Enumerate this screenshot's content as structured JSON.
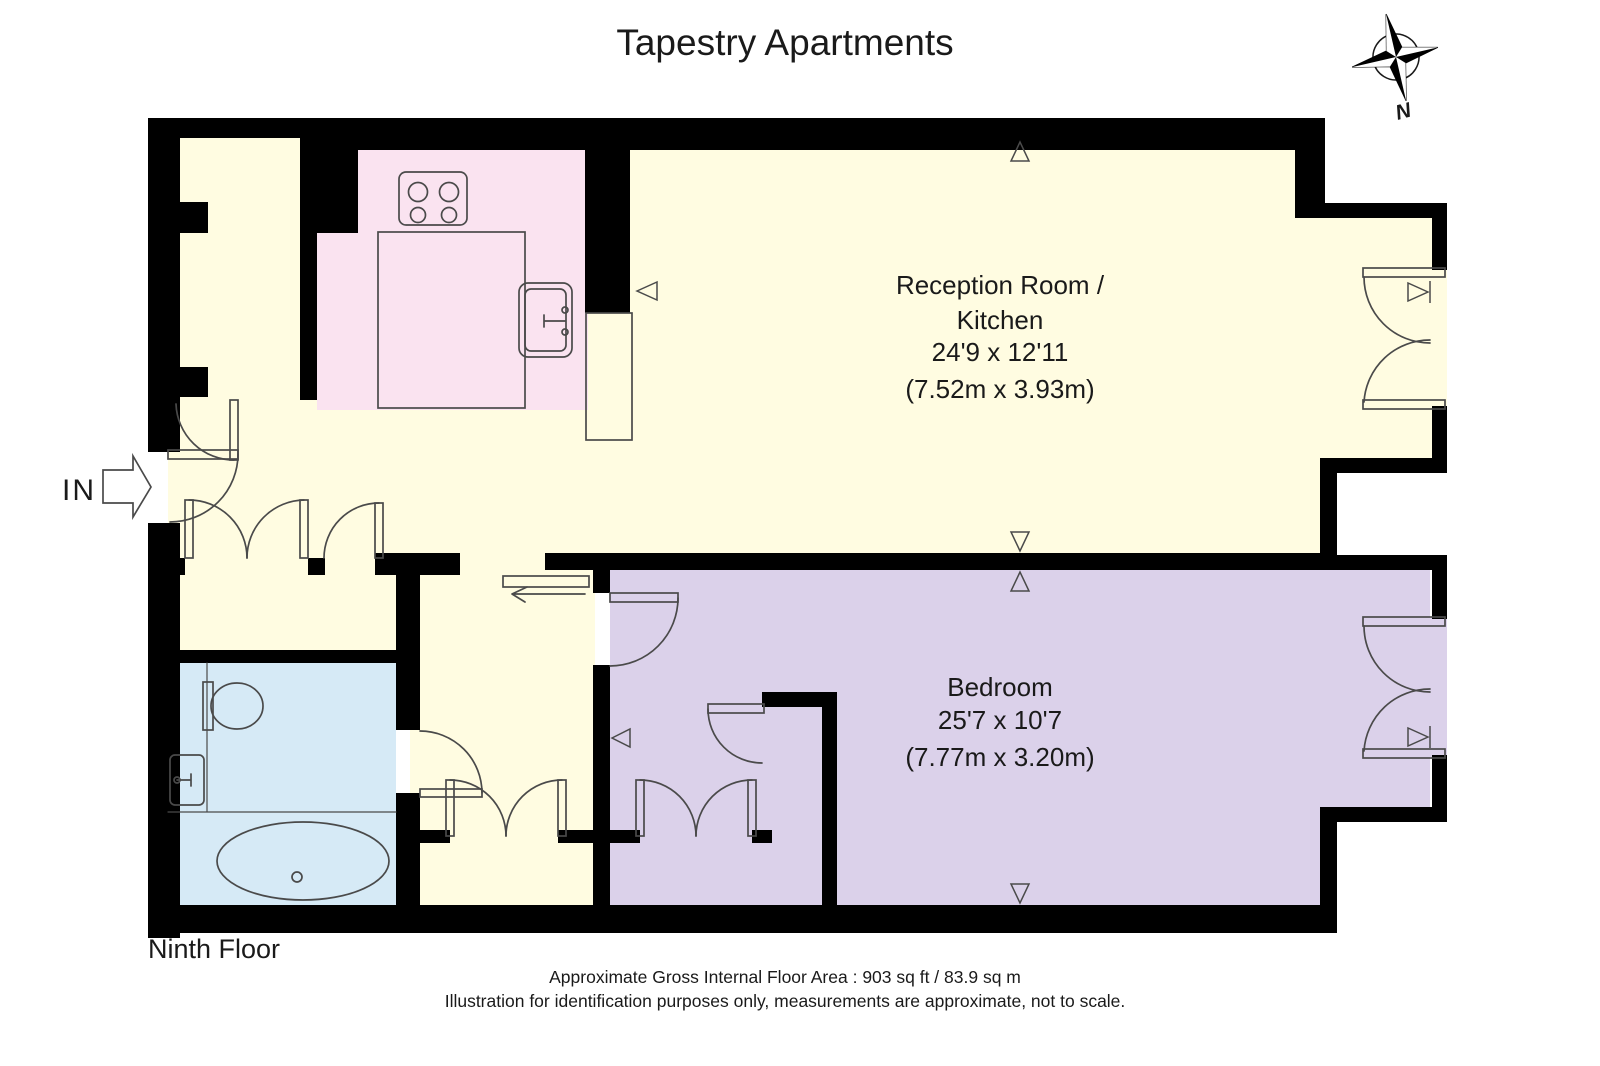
{
  "title": "Tapestry Apartments",
  "compass": {
    "label": "N"
  },
  "entrance": {
    "label": "IN"
  },
  "rooms": {
    "reception": {
      "lines": [
        "Reception Room /",
        "Kitchen",
        "24'9 x 12'11",
        "(7.52m x 3.93m)"
      ]
    },
    "bedroom": {
      "lines": [
        "Bedroom",
        "25'7 x 10'7",
        "(7.77m x 3.20m)"
      ]
    }
  },
  "footer": {
    "floor": "Ninth Floor",
    "area": "Approximate Gross Internal Floor Area : 903 sq ft / 83.9 sq m",
    "disclaimer": "Illustration for identification purposes only, measurements are approximate, not to scale."
  },
  "colors": {
    "cream": "#FFFCE1",
    "kitchen_pink": "#FAE3F0",
    "bathroom_blue": "#D6EAF6",
    "bedroom_purple": "#DBD1EA",
    "wall": "#000000",
    "line": "#4a4a4a",
    "text": "#1a1a1a"
  }
}
